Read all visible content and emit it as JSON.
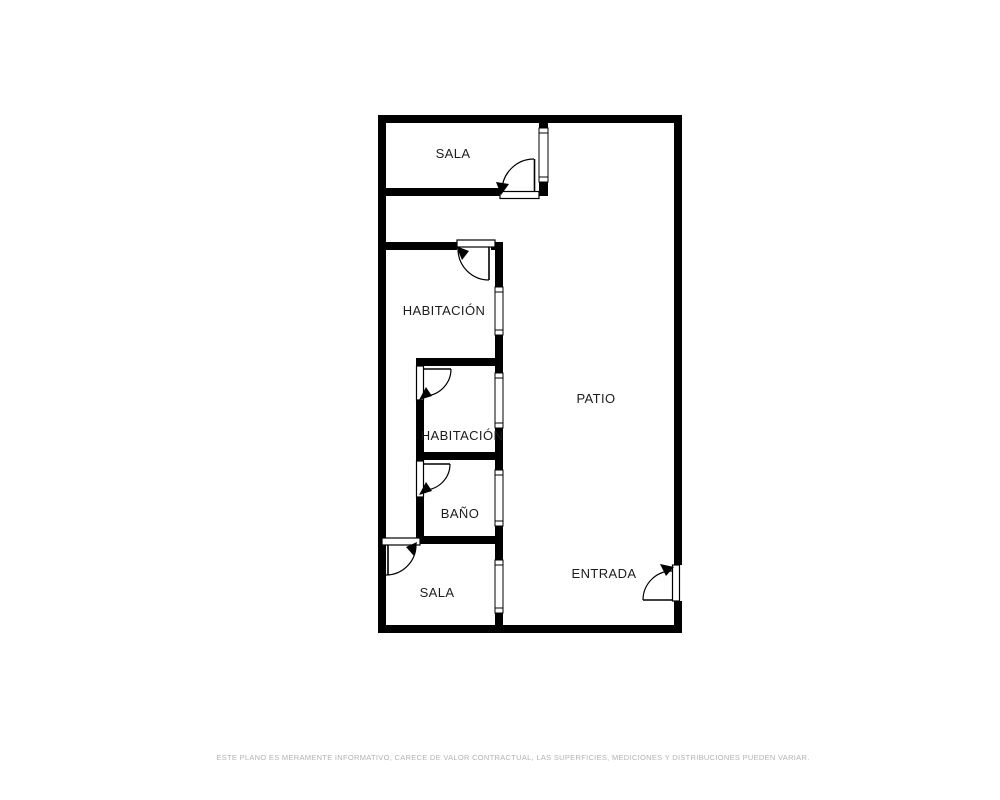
{
  "colors": {
    "wall": "#000000",
    "label_text": "#1c1c1c",
    "disclaimer_text": "#b2b2b2",
    "background": "#ffffff"
  },
  "rooms": [
    {
      "id": "sala-top",
      "label": "SALA"
    },
    {
      "id": "habitacion-1",
      "label": "HABITACIÓN"
    },
    {
      "id": "habitacion-2",
      "label": "HABITACIÓN"
    },
    {
      "id": "bano",
      "label": "BAÑO"
    },
    {
      "id": "sala-bottom",
      "label": "SALA"
    },
    {
      "id": "patio",
      "label": "PATIO"
    },
    {
      "id": "entrada",
      "label": "ENTRADA"
    }
  ],
  "disclaimer": "ESTE PLANO ES MERAMENTE INFORMATIVO, CARECE DE VALOR CONTRACTUAL, LAS SUPERFICIES, MEDICIONES Y DISTRIBUCIONES PUEDEN VARIAR."
}
